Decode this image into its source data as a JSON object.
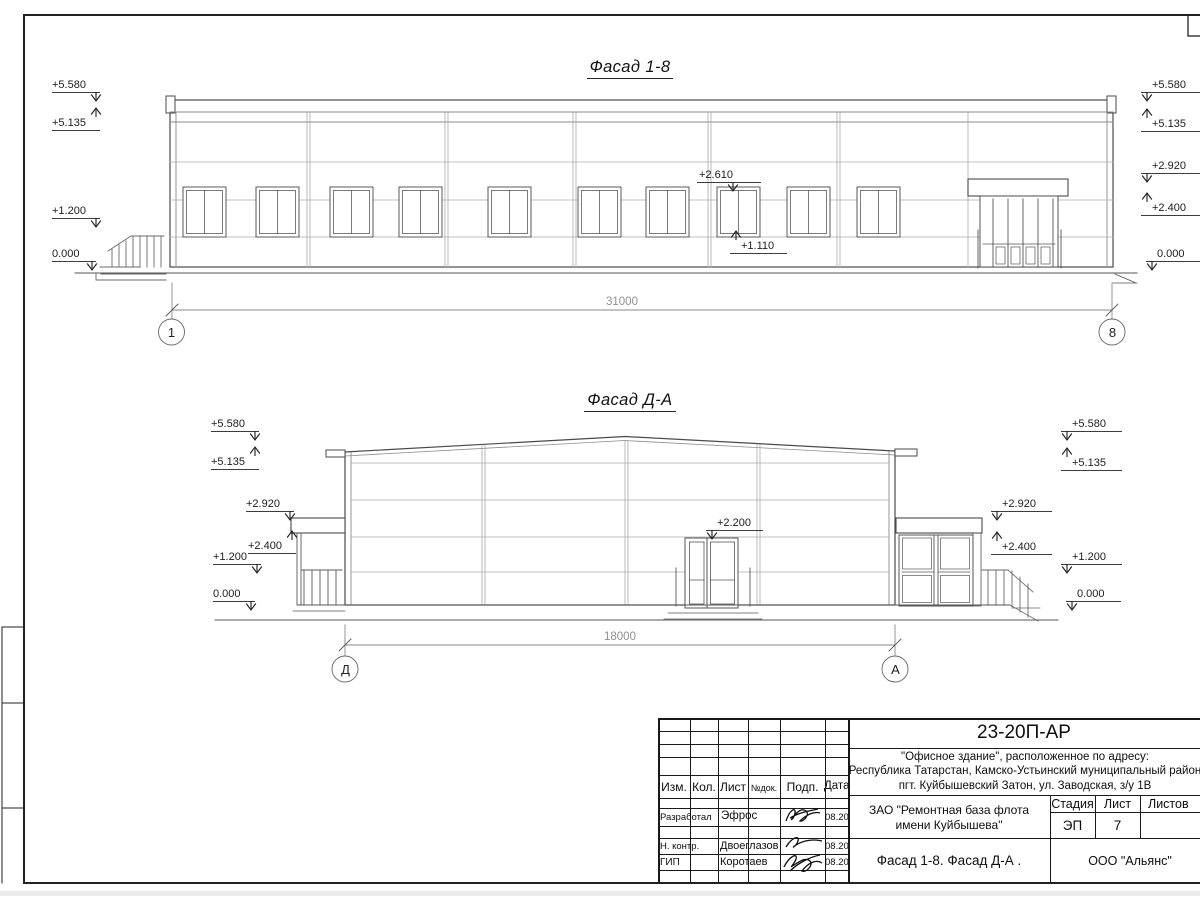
{
  "facade18": {
    "title": "Фасад 1-8",
    "dimension": "31000",
    "axis_left": "1",
    "axis_right": "8",
    "elev_left": [
      "+5.580",
      "+5.135",
      "+1.200",
      "0.000"
    ],
    "elev_right": [
      "+5.580",
      "+5.135",
      "+2.920",
      "+2.400",
      "0.000"
    ],
    "elev_window_top": "+2.610",
    "elev_window_sill": "+1.110"
  },
  "facadeDA": {
    "title": "Фасад Д-А",
    "dimension": "18000",
    "axis_left": "Д",
    "axis_right": "А",
    "elev_left": [
      "+5.580",
      "+5.135",
      "+2.920",
      "+2.400",
      "+1.200",
      "0.000"
    ],
    "elev_right": [
      "+5.580",
      "+5.135",
      "+2.920",
      "+2.400",
      "+1.200",
      "0.000"
    ],
    "elev_door_top": "+2.200"
  },
  "titleblock": {
    "doc_number": "23-20П-АР",
    "address_line1": "\"Офисное здание\", расположенное по адресу:",
    "address_line2": "Республика Татарстан, Камско-Устьинский муниципальный район",
    "address_line3": "пгт. Куйбышевский Затон, ул. Заводская, з/у 1В",
    "client_line1": "ЗАО \"Ремонтная база флота",
    "client_line2": "имени Куйбышева\"",
    "sheet_title": "Фасад 1-8. Фасад Д-А .",
    "company": "ООО \"Альянс\"",
    "cols": {
      "izm": "Изм.",
      "kol": "Кол.",
      "list": "Лист",
      "ndok": "№док.",
      "podp": "Подп.",
      "data": "Дата"
    },
    "stadia_label": "Стадия",
    "list_label": "Лист",
    "listov_label": "Листов",
    "stadia_value": "ЭП",
    "list_value": "7",
    "rows": [
      {
        "role": "Разработал",
        "name": "Эфрос",
        "date": "08.20"
      },
      {
        "role": "Н. контр.",
        "name": "Двоеглазов",
        "date": "08.20"
      },
      {
        "role": "ГИП",
        "name": "Коротаев",
        "date": "08.20"
      }
    ]
  }
}
